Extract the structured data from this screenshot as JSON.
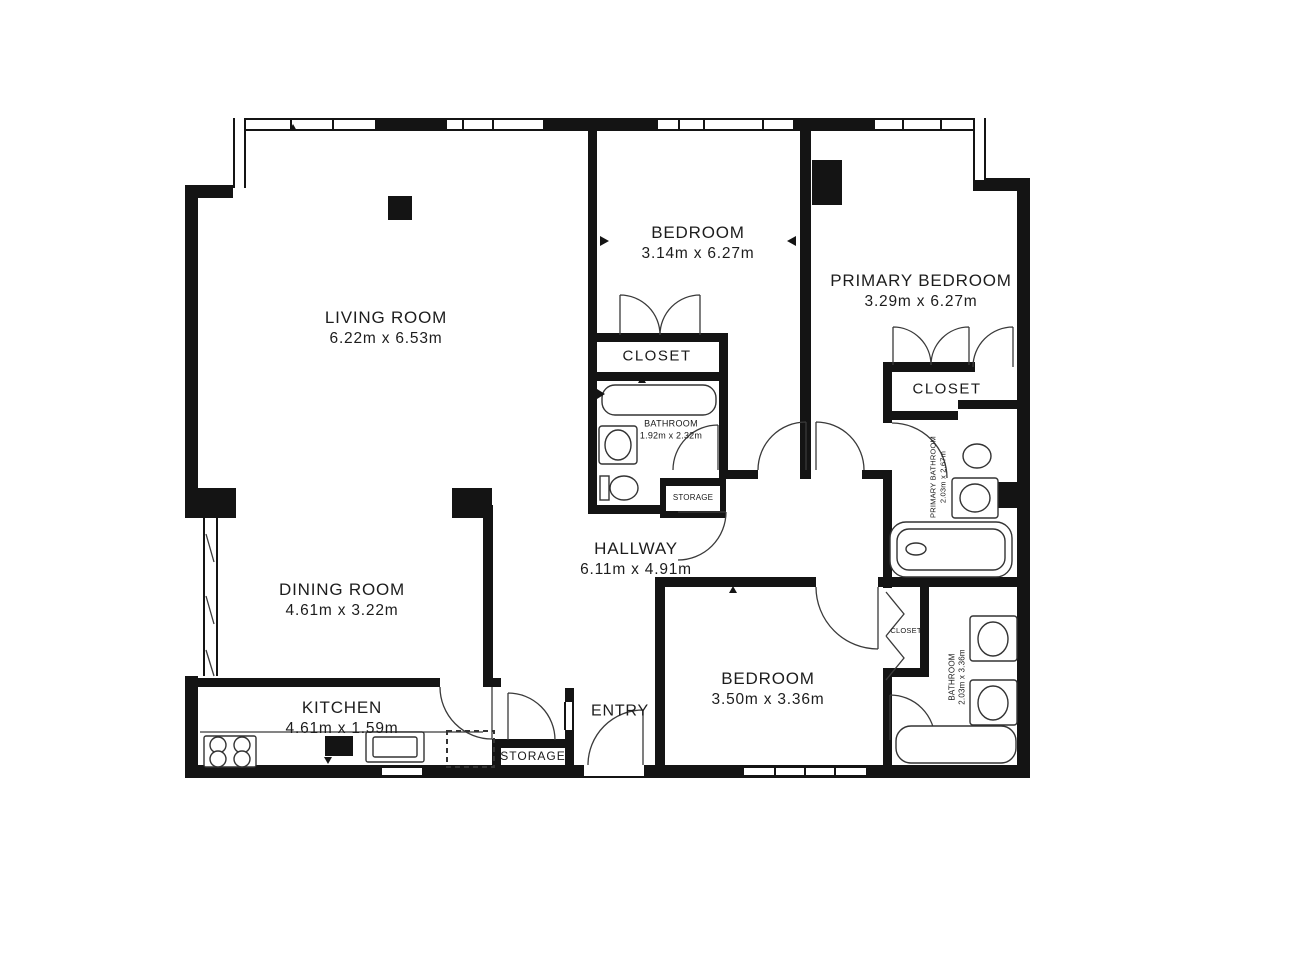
{
  "figure_type": "floor_plan",
  "colors": {
    "wall": "#141414",
    "line": "#3a3a3a",
    "text": "#1d1d1d",
    "background": "#ffffff"
  },
  "rooms": {
    "living_room": {
      "name": "LIVING ROOM",
      "dims": "6.22m x 6.53m"
    },
    "bedroom_top": {
      "name": "BEDROOM",
      "dims": "3.14m x 6.27m"
    },
    "primary_bedroom": {
      "name": "PRIMARY BEDROOM",
      "dims": "3.29m x 6.27m"
    },
    "closet_mid": {
      "name": "CLOSET"
    },
    "bathroom_mid": {
      "name": "BATHROOM",
      "dims": "1.92m x 2.32m"
    },
    "storage_mid": {
      "name": "STORAGE"
    },
    "hallway": {
      "name": "HALLWAY",
      "dims": "6.11m x 4.91m"
    },
    "dining_room": {
      "name": "DINING ROOM",
      "dims": "4.61m x 3.22m"
    },
    "kitchen": {
      "name": "KITCHEN",
      "dims": "4.61m x 1.59m"
    },
    "storage_bottom": {
      "name": "STORAGE"
    },
    "entry": {
      "name": "ENTRY"
    },
    "bedroom_bottom": {
      "name": "BEDROOM",
      "dims": "3.50m x 3.36m"
    },
    "closet_bedroom": {
      "name": "CLOSET"
    },
    "bathroom_bottom": {
      "name": "BATHROOM",
      "dims": "2.03m x 3.36m"
    },
    "primary_bathroom": {
      "name": "PRIMARY BATHROOM",
      "dims": "2.03m x 2.67m"
    },
    "closet_primary": {
      "name": "CLOSET"
    }
  }
}
